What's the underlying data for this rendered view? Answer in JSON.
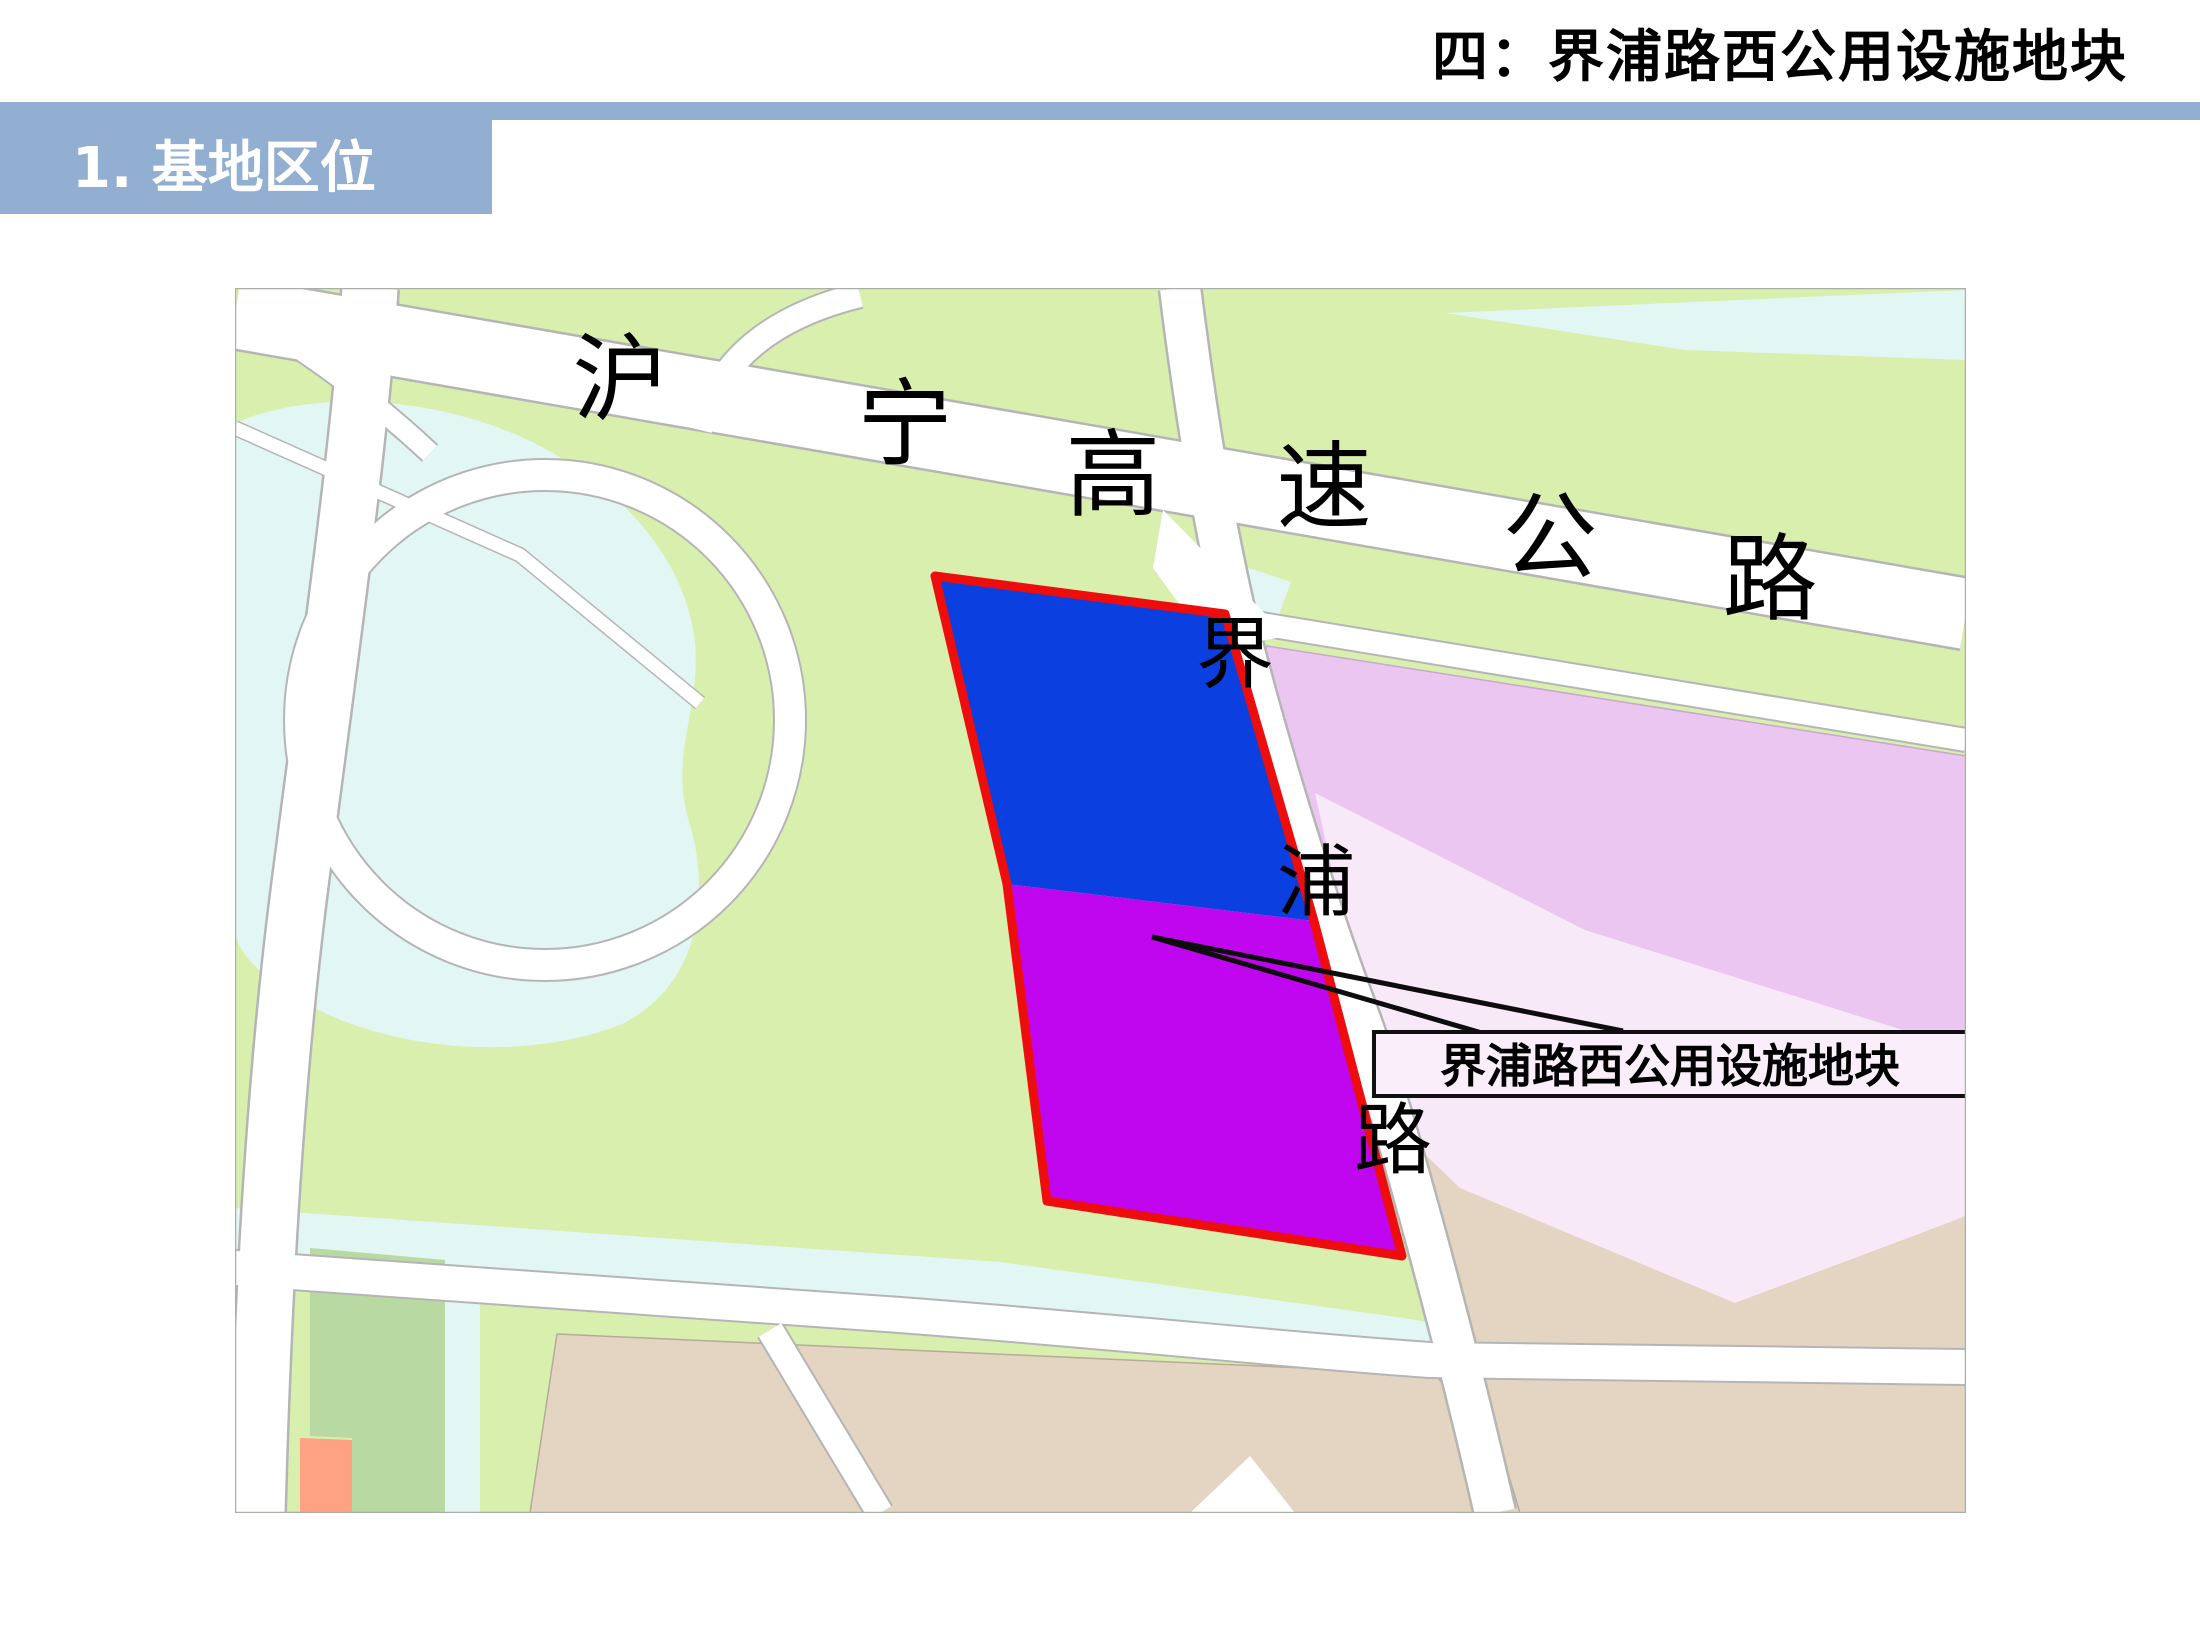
{
  "title": "四：界浦路西公用设施地块",
  "header": {
    "label": "1. 基地区位"
  },
  "map": {
    "highway": {
      "name": "沪宁高速公路",
      "chars": [
        "沪",
        "宁",
        "高",
        "速",
        "公",
        "路"
      ]
    },
    "jiepu_road": {
      "name": "界浦路",
      "chars": [
        "界",
        "浦",
        "路"
      ]
    },
    "callout": {
      "label": "界浦路西公用设施地块"
    },
    "plot": {
      "name": "界浦路西公用设施地块",
      "north_color": "#0b3fe0",
      "south_color": "#bf06ef",
      "outline_color": "#ee0d0d"
    }
  },
  "colors": {
    "header_bar": "#92afd2",
    "map_green": "#d9efae",
    "water": "#e2f6f3",
    "tan": "#e3d5c1",
    "lavender": "#ebc6f0",
    "lavender_light": "#f8e9f9",
    "dark_green_parcel": "#b9d9a2",
    "salmon": "#ffa183",
    "road_fill": "#ffffff",
    "road_casing": "#b5b5b5",
    "callout_fill": "#fbeefb",
    "map_border": "#a9b0a6"
  }
}
